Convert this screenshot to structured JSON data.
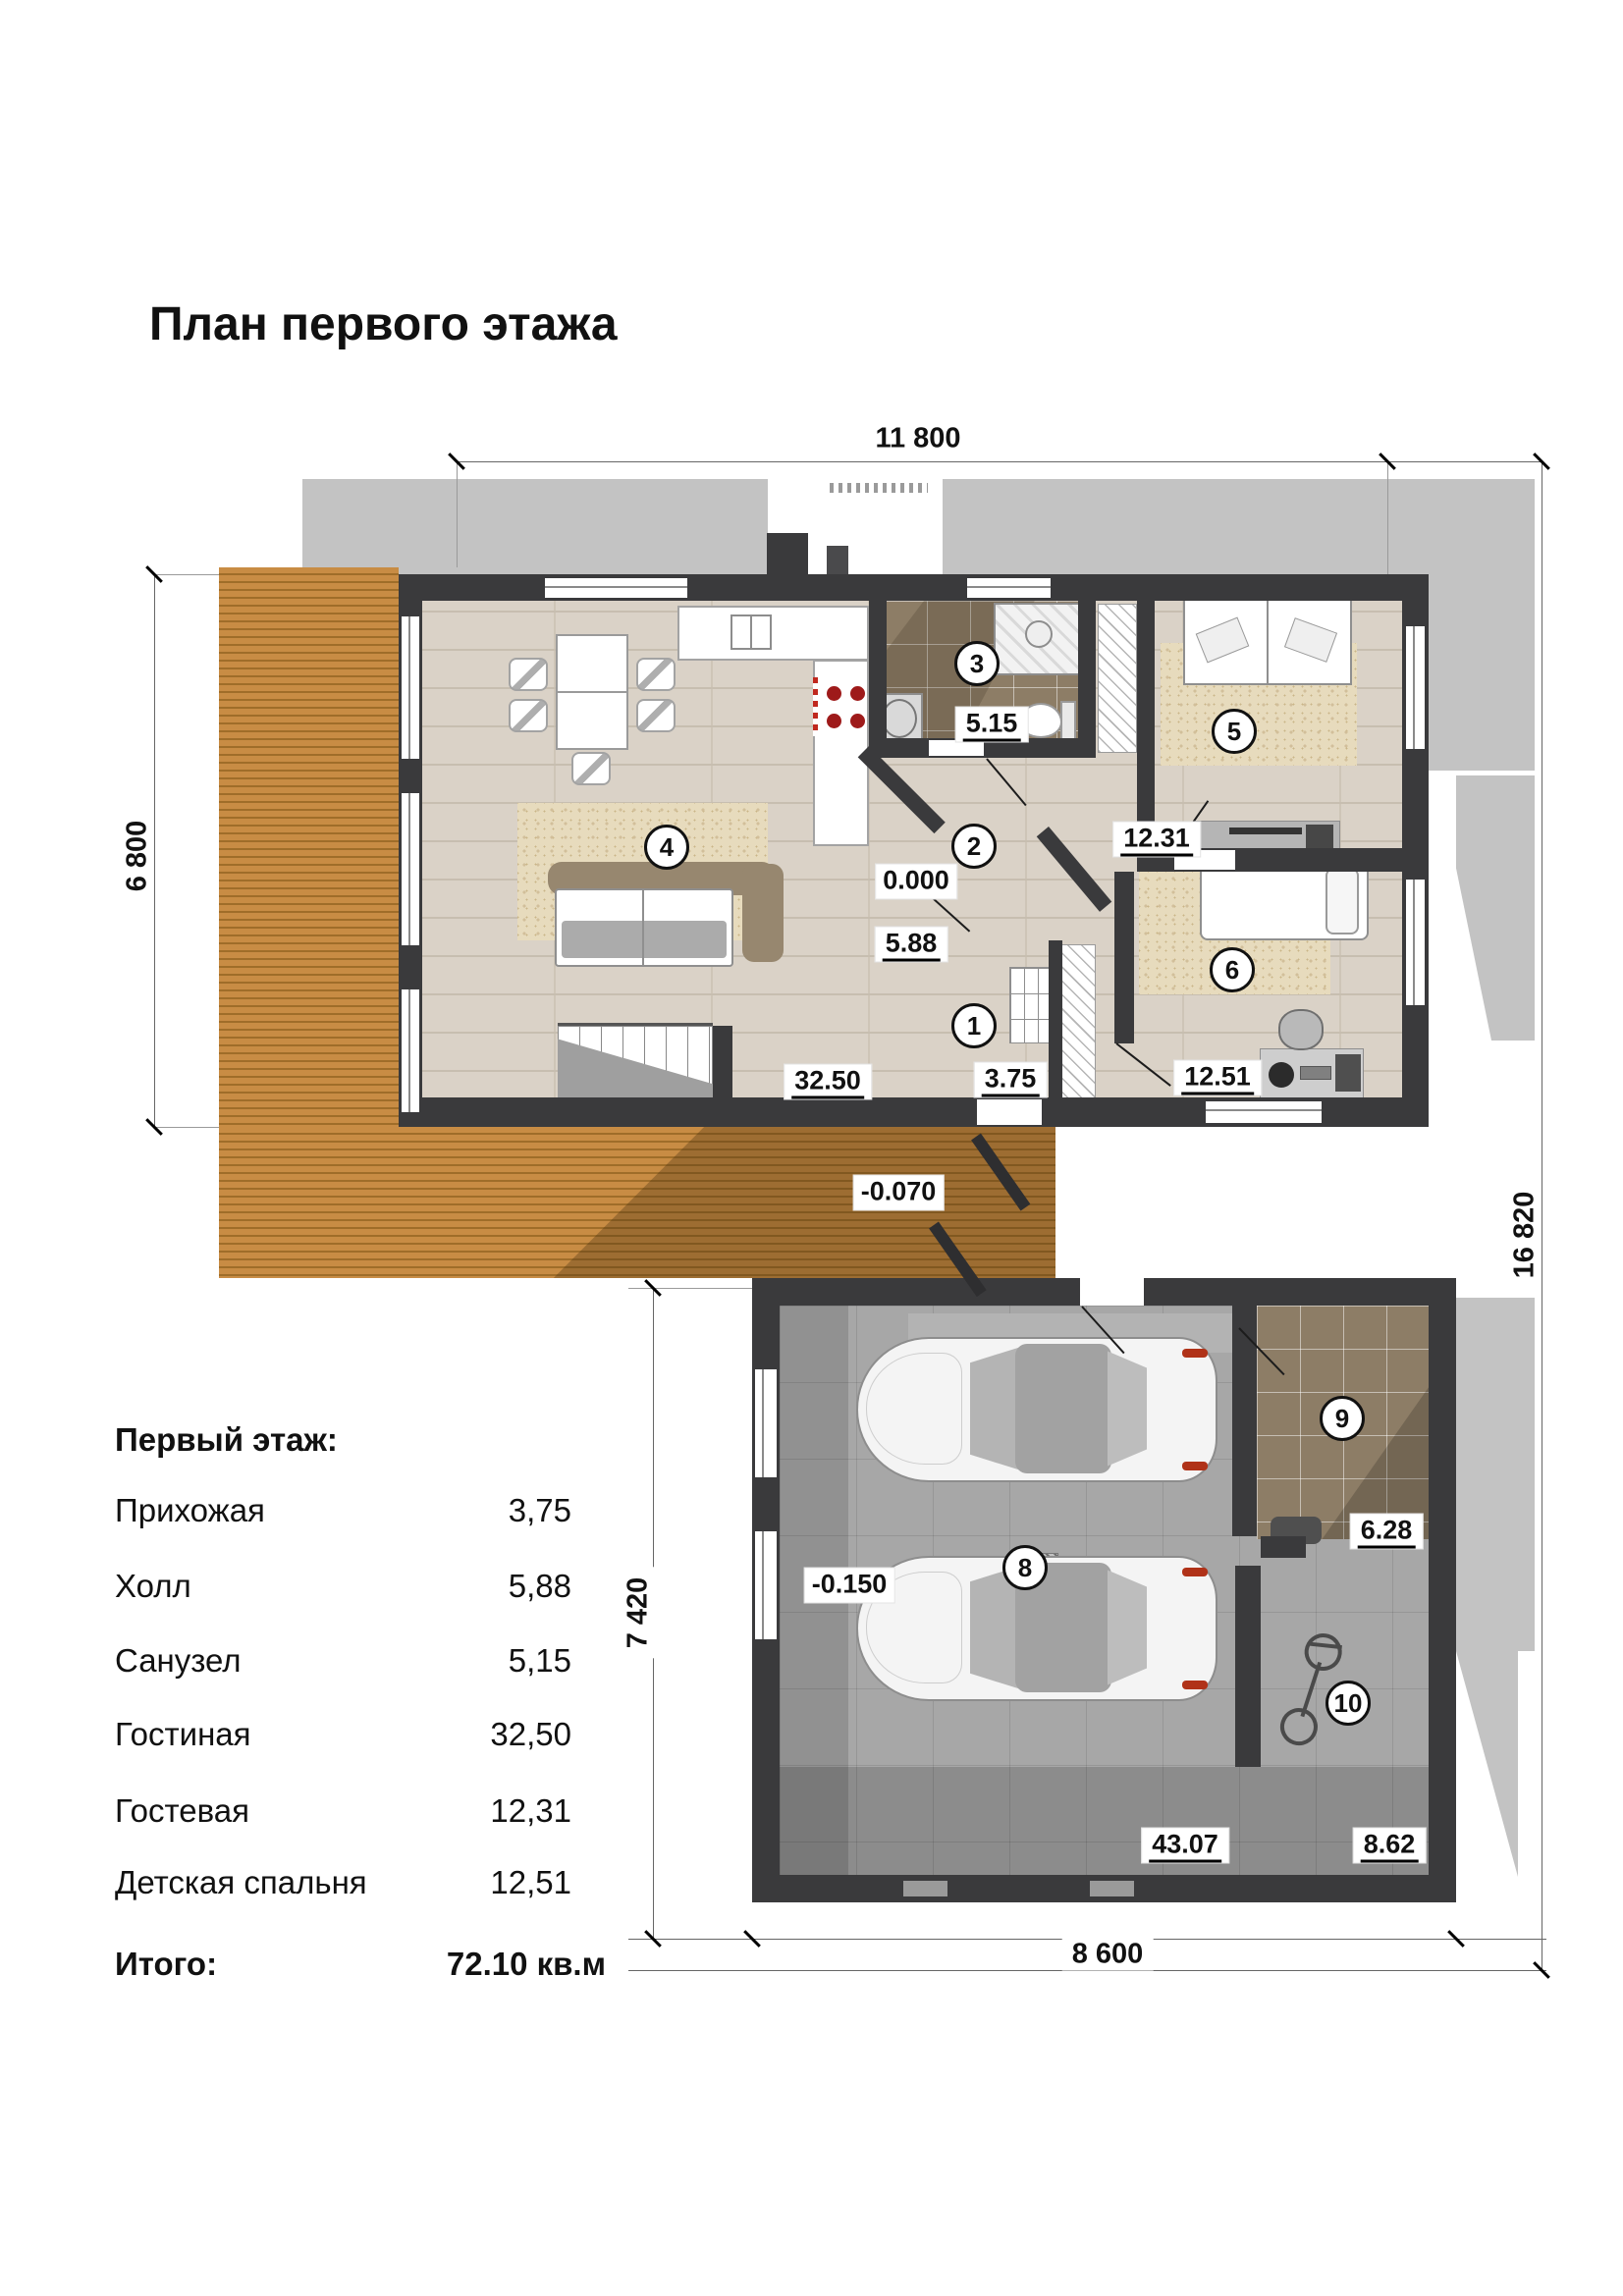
{
  "title": "План первого этажа",
  "dims": {
    "top": "11 800",
    "left": "6 800",
    "right": "16 820",
    "garage_left": "7 420",
    "bottom": "8 600"
  },
  "elevations": {
    "main_floor": "0.000",
    "terrace": "-0.070",
    "garage": "-0.150"
  },
  "rooms": [
    {
      "num": "1",
      "area": "3.75"
    },
    {
      "num": "2",
      "area": "5.88"
    },
    {
      "num": "3",
      "area": "5.15"
    },
    {
      "num": "4",
      "area": "32.50"
    },
    {
      "num": "5",
      "area": "12.31"
    },
    {
      "num": "6",
      "area": "12.51"
    },
    {
      "num": "8",
      "area": "43.07"
    },
    {
      "num": "9",
      "area": "6.28"
    },
    {
      "num": "10",
      "area": "8.62"
    }
  ],
  "legend": {
    "heading": "Первый этаж:",
    "rows": [
      {
        "name": "Прихожая",
        "area": "3,75"
      },
      {
        "name": "Холл",
        "area": "5,88"
      },
      {
        "name": "Санузел",
        "area": "5,15"
      },
      {
        "name": "Гостиная",
        "area": "32,50"
      },
      {
        "name": "Гостевая",
        "area": "12,31"
      },
      {
        "name": "Детская спальня",
        "area": "12,51"
      }
    ],
    "total_label": "Итого:",
    "total_value": "72.10 кв.м"
  },
  "colors": {
    "wall": "#3a3a3c",
    "roof_shadow": "#c3c3c3",
    "deck_wood": "#c88c44",
    "floor_wood": "#dad2c7",
    "garage_floor": "#a7a7a7",
    "burner_red": "#9e1a1a"
  }
}
